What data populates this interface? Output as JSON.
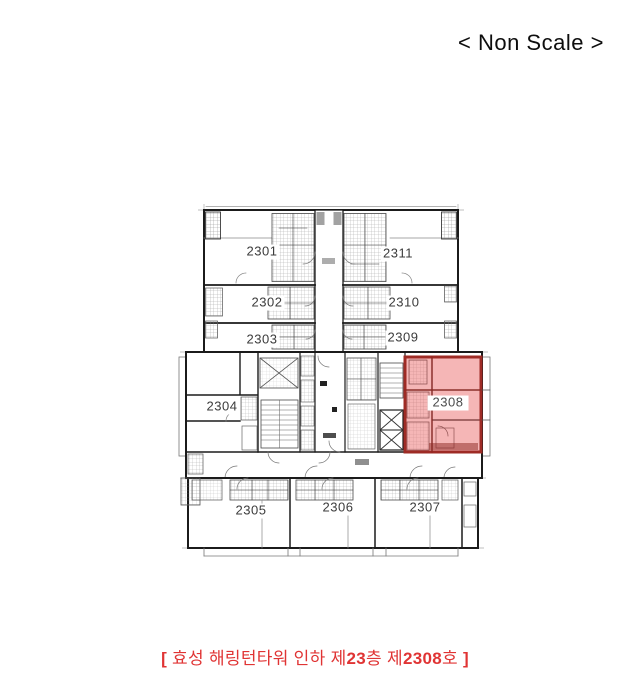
{
  "scale_note": "< Non Scale >",
  "floor_plan": {
    "units": [
      {
        "label": "2301"
      },
      {
        "label": "2302"
      },
      {
        "label": "2303"
      },
      {
        "label": "2304"
      },
      {
        "label": "2305"
      },
      {
        "label": "2306"
      },
      {
        "label": "2307"
      },
      {
        "label": "2309"
      },
      {
        "label": "2310"
      },
      {
        "label": "2311"
      }
    ],
    "highlighted_unit": {
      "label": "2308",
      "fill_color": "#e85050",
      "border_color": "#9e2b25"
    }
  },
  "caption": {
    "full_text": "[ 효성 해링턴타워 인하 제23층 제2308호 ]",
    "bracket_open": "[ ",
    "building_text": "효성 해링턴타워 인하 제",
    "floor_number": "23",
    "floor_suffix": "층 제",
    "unit_number": "2308",
    "unit_suffix": "호 ",
    "bracket_close": "]",
    "color": "#e03434"
  }
}
